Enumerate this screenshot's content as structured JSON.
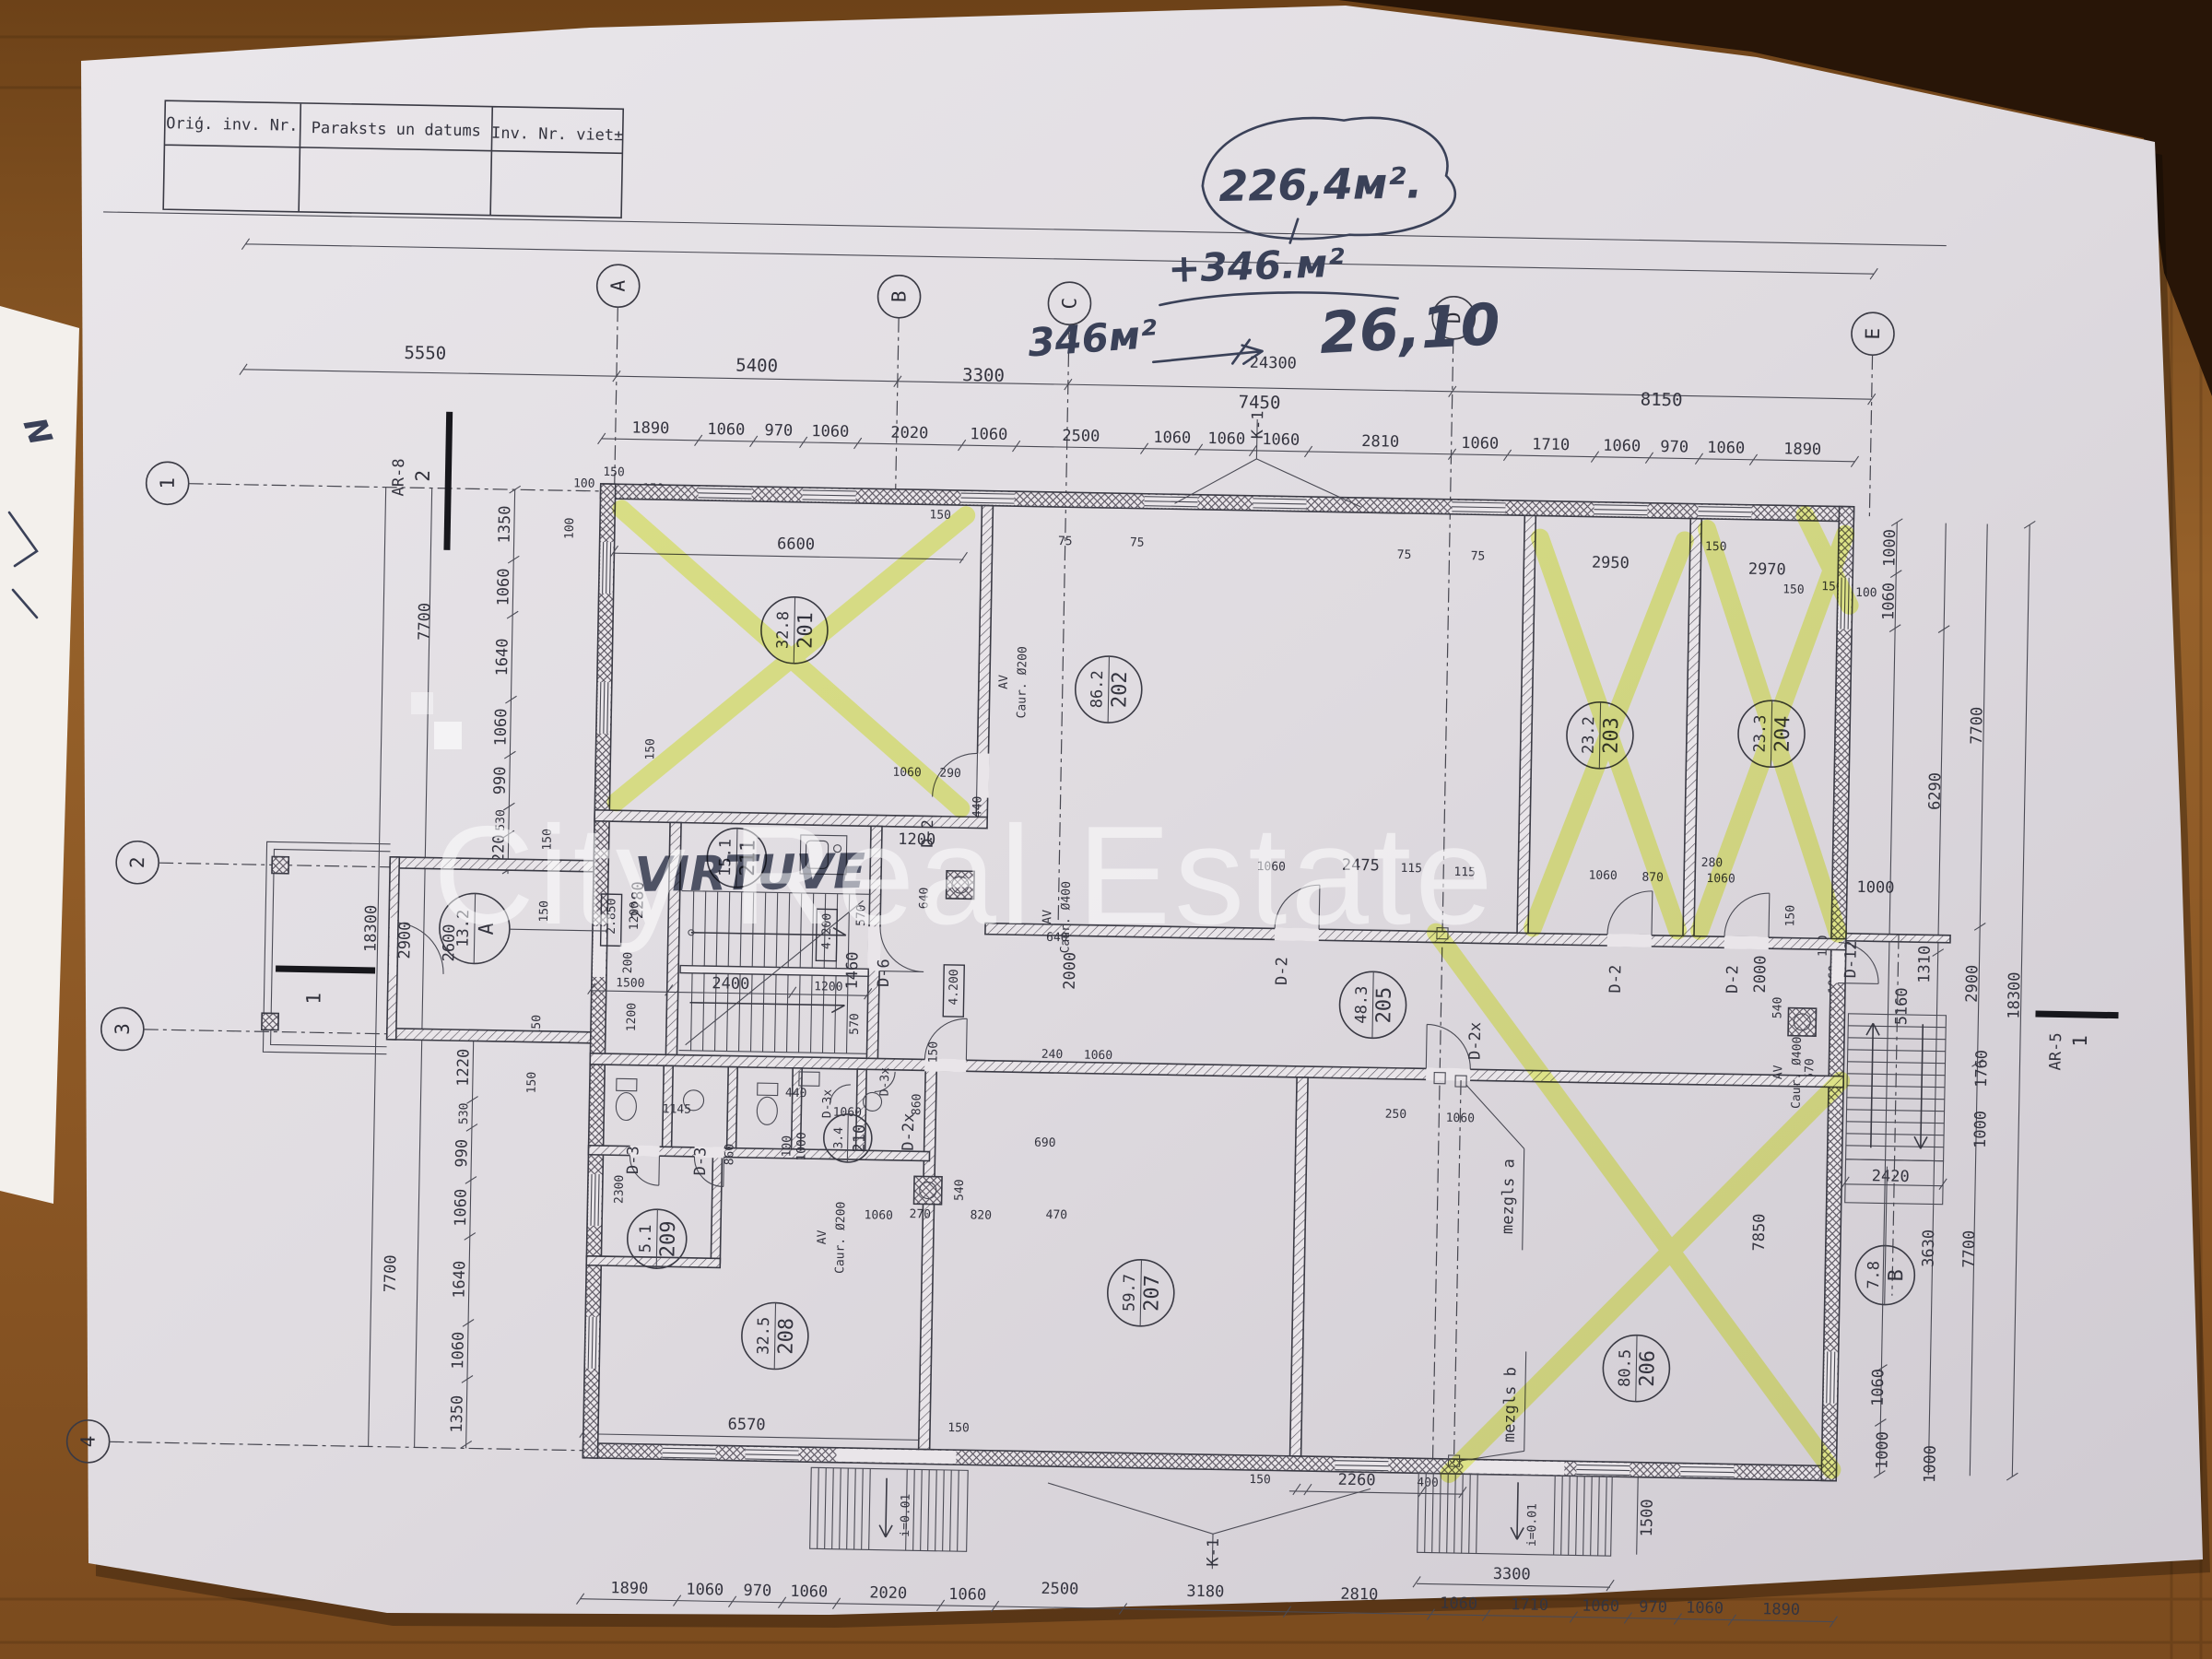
{
  "colors": {
    "paper": "#e2dee3",
    "wood": "#8a5624",
    "marker_yellow": "#e7fa3c",
    "pen_blue": "#3a4158",
    "ink": "#34343f"
  },
  "table": {
    "headers": [
      "Oriģ. inv. Nr.",
      "Paraksts un datums",
      "Inv. Nr. viet±"
    ]
  },
  "handwriting": {
    "circled_area": "226,4м².",
    "added_area": "+346.м²",
    "note_area": "346м²",
    "result": "26,10",
    "kitchen_note": "VIRTUVE",
    "margin_mark": "N"
  },
  "watermark": {
    "text": "City Real Estate"
  },
  "grid": {
    "cols": [
      "A",
      "B",
      "C",
      "D",
      "E"
    ],
    "rows": [
      "1",
      "2",
      "3",
      "4"
    ]
  },
  "sections": {
    "plan_cut_num": "2",
    "plan_cut_ref": "AR-8",
    "side_cut_num": "1",
    "side_cut_ref": "AR-5",
    "porch_cut_num": "1"
  },
  "rooms": [
    {
      "num": "201",
      "area": "32.8"
    },
    {
      "num": "202",
      "area": "86.2"
    },
    {
      "num": "203",
      "area": "23.2"
    },
    {
      "num": "204",
      "area": "23.3"
    },
    {
      "num": "205",
      "area": "48.3"
    },
    {
      "num": "206",
      "area": "80.5"
    },
    {
      "num": "207",
      "area": "59.7"
    },
    {
      "num": "208",
      "area": "32.5"
    },
    {
      "num": "209",
      "area": "5.1"
    },
    {
      "num": "210",
      "area": "3.4"
    },
    {
      "num": "211",
      "area": "15.1"
    },
    {
      "num": "A",
      "area": "13.2"
    },
    {
      "num": "B",
      "area": "7.8"
    }
  ],
  "doors": {
    "d2": "D-2",
    "d2x": "D-2x",
    "d3": "D-3",
    "d3x": "D-3x",
    "d6": "D-6",
    "d12": "D-12"
  },
  "notes": {
    "k1": "K-1",
    "slope": "i=0.01",
    "mezgls_a": "mezgls a",
    "mezgls_b": "mezgls b",
    "av": "AV",
    "caur200": "Caur. Ø200",
    "caur400": "Caur. Ø400",
    "level_a": "2.850",
    "level_b": "4.200"
  },
  "dims": {
    "top_total": "24300",
    "top_overall": [
      "5550",
      "5400",
      "3300",
      "7450",
      "8150"
    ],
    "top_detail": [
      "1890",
      "1060",
      "970",
      "1060",
      "2020",
      "1060",
      "2500",
      "1060",
      "1060",
      "1060",
      "2810",
      "1060",
      "1710",
      "1060",
      "970",
      "1060",
      "1890"
    ],
    "top_small_left": [
      "100",
      "150",
      "150"
    ],
    "top_small_right": [
      "150",
      "150",
      "100"
    ],
    "left_overall": [
      "7700",
      "18300",
      "2900",
      "2600",
      "7700"
    ],
    "left_top": [
      "1350",
      "1060",
      "1640",
      "1060",
      "990",
      "530",
      "1220"
    ],
    "left_bottom": [
      "1220",
      "530",
      "990",
      "1060",
      "1640",
      "1060",
      "1350"
    ],
    "left_small": "150",
    "right_top": [
      "1000",
      "1060",
      "7700",
      "6290",
      "150"
    ],
    "right_overall": [
      "18300",
      "2900",
      "1760",
      "1000",
      "3630",
      "7700"
    ],
    "right_bottom": [
      "1060",
      "1000"
    ],
    "right_stair": [
      "1310",
      "5160",
      "2420",
      "2000",
      "540",
      "570",
      "100",
      "1060",
      "7850"
    ],
    "bottom_detail": [
      "1890",
      "1060",
      "970",
      "1060",
      "2020",
      "1060",
      "2500",
      "3180",
      "2810",
      "1060",
      "1710",
      "1060",
      "970",
      "1060",
      "1890"
    ],
    "bottom_misc": [
      "6570",
      "150",
      "150",
      "2260",
      "400",
      "3300",
      "1500",
      "1000"
    ],
    "room201": [
      "6600",
      "150",
      "1060",
      "290",
      "440",
      "2280"
    ],
    "pair75": "75",
    "rooms_top_right": [
      "2950",
      "150",
      "2970",
      "1060",
      "870",
      "1060",
      "280",
      "1000"
    ],
    "corridor": [
      "1060",
      "2475",
      "115",
      "115",
      "250",
      "1060",
      "240",
      "1060",
      "690"
    ],
    "stair": [
      "1200",
      "640",
      "570",
      "1460",
      "570",
      "200",
      "1200",
      "1200",
      "1500",
      "2400",
      "1200",
      "640",
      "2000",
      "150"
    ],
    "wc": [
      "1145",
      "1060",
      "440",
      "860",
      "100",
      "1000",
      "2300",
      "860"
    ],
    "ducts": [
      "540",
      "1060",
      "270",
      "820",
      "470"
    ]
  }
}
